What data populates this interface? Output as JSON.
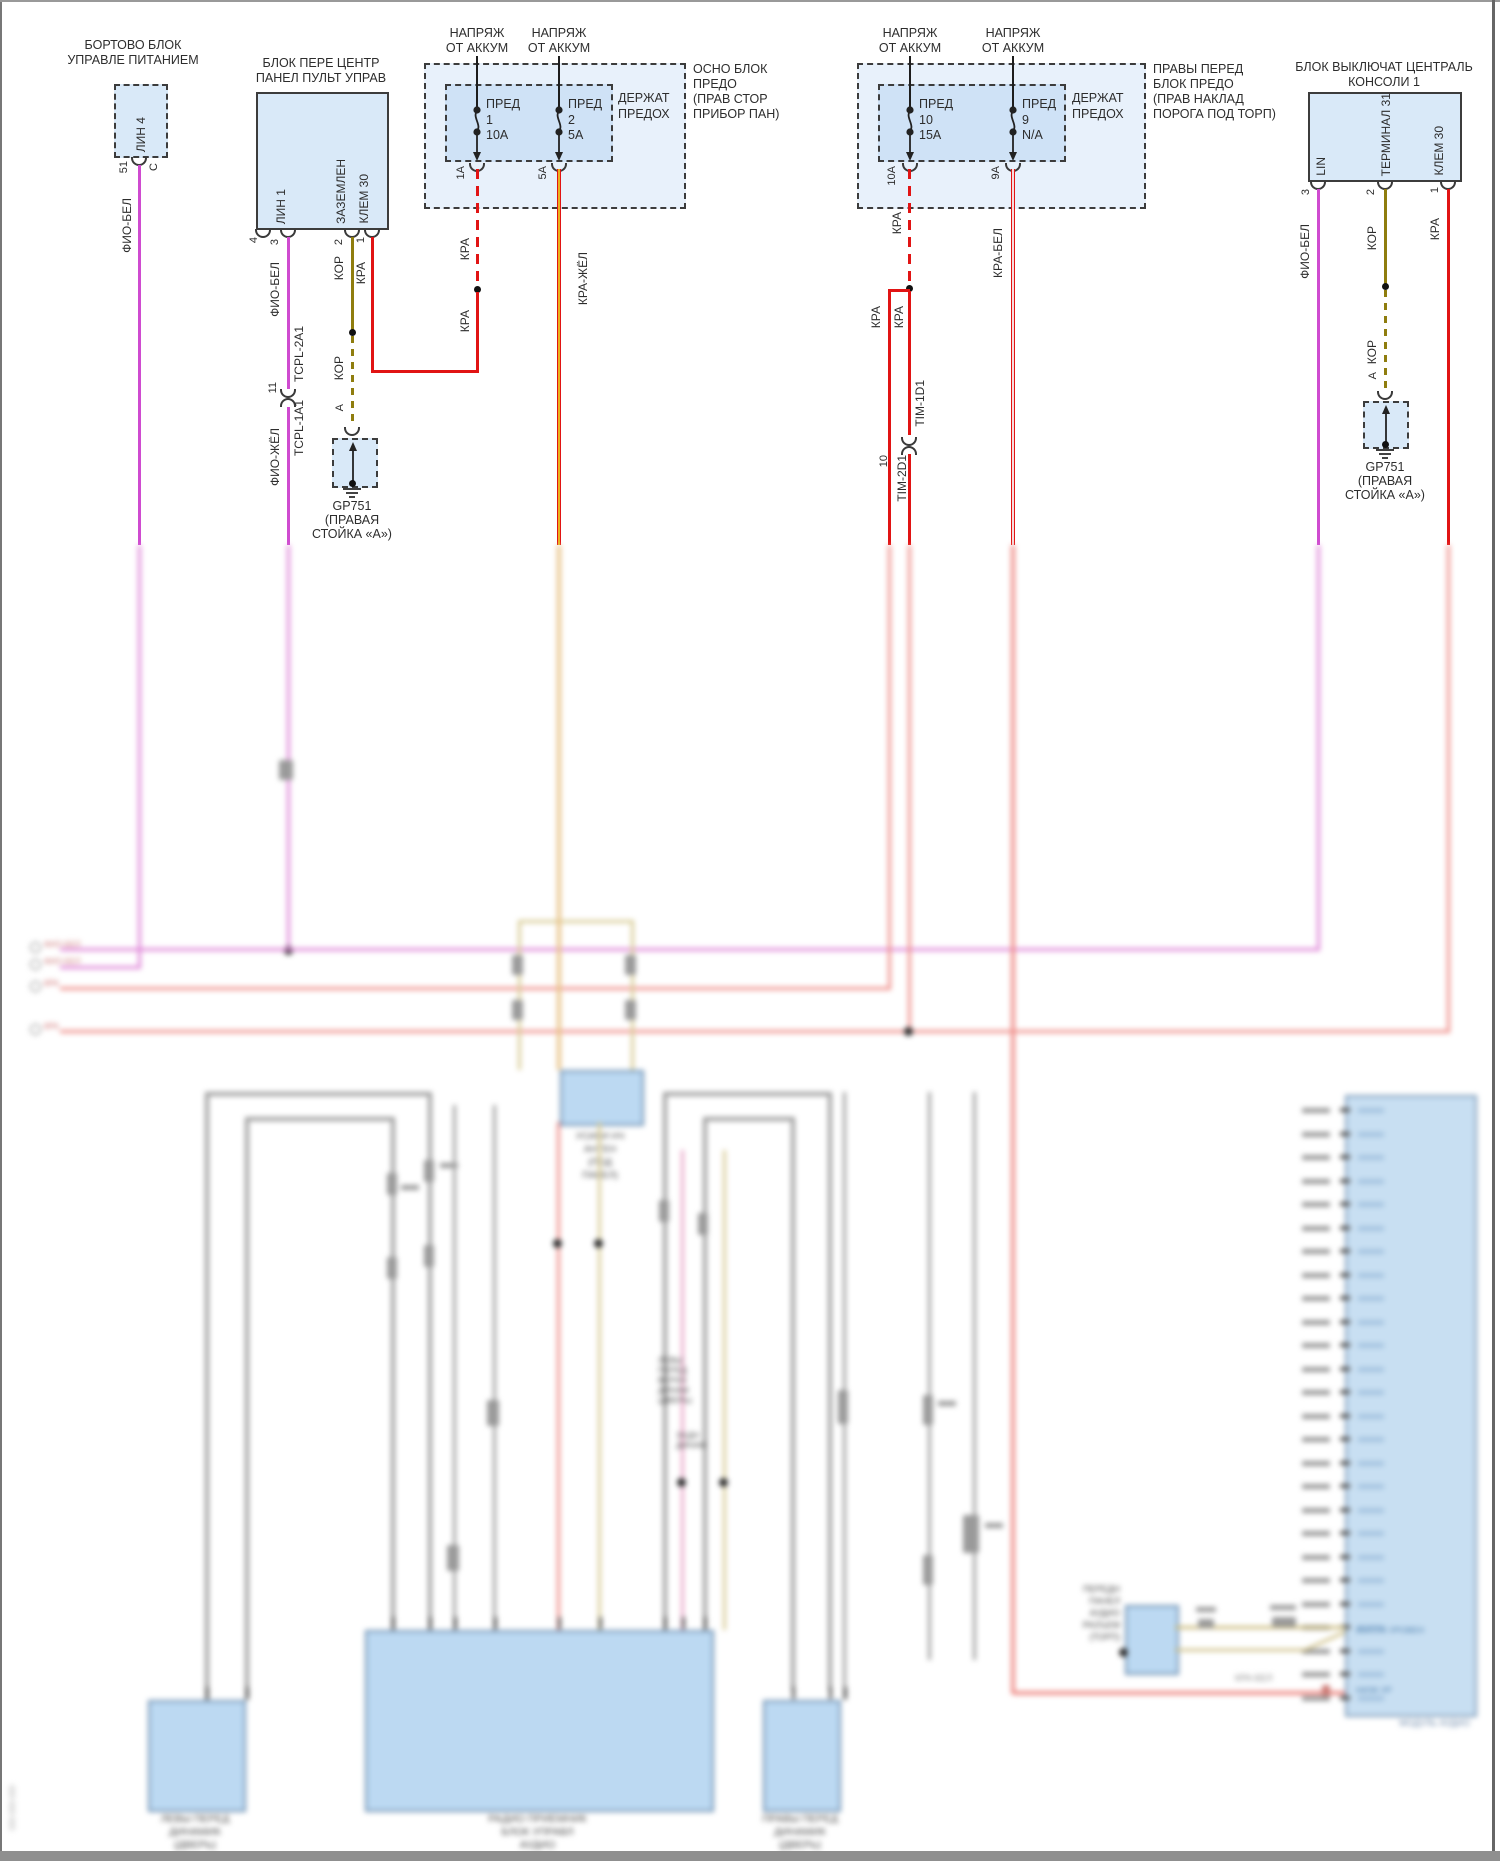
{
  "colors": {
    "wire_magenta": "#cf4bd0",
    "wire_olive": "#8f7d0e",
    "wire_red": "#e11414",
    "wire_red_yellow_stripe": "#e9b21c",
    "block_fill": "#d9e9f8"
  },
  "b1": {
    "title1": "БОРТОВО БЛОК",
    "title2": "УПРАВЛЕ ПИТАНИЕМ",
    "pin": "ЛИН 4",
    "num": "51",
    "conn_letter": "C",
    "wire": "ФИО-БЕЛ"
  },
  "b2": {
    "title1": "БЛОК ПЕРЕ ЦЕНТР",
    "title2": "ПАНЕЛ ПУЛЬТ УПРАВ",
    "pin_lin": "ЛИН 1",
    "pin_gnd": "ЗАЗЕМЛЕН",
    "pin_klem": "КЛЕМ 30",
    "n4": "4",
    "n3": "3",
    "n2": "2",
    "n1": "1",
    "w_fio_bel": "ФИО-БЕЛ",
    "n11": "11",
    "tcpl_top": "TCPL-2A1",
    "tcpl_bot": "TCPL-1A1",
    "w_fio_zhel": "ФИО-ЖЁЛ",
    "kor": "КОР",
    "kor2": "КОР",
    "kra": "КРА",
    "a": "А",
    "gp": "GP751",
    "gp2": "(ПРАВАЯ",
    "gp3": "СТОЙКА «А»)"
  },
  "fb1": {
    "feed1": [
      "НАПРЯЖ",
      "ОТ АККУМ"
    ],
    "feed2": [
      "НАПРЯЖ",
      "ОТ АККУМ"
    ],
    "holder": [
      "ДЕРЖАТ",
      "ПРЕДОХ"
    ],
    "f1": {
      "t": "ПРЕД",
      "n": "1",
      "a": "10A",
      "out": "1A"
    },
    "f2": {
      "t": "ПРЕД",
      "n": "2",
      "a": "5A",
      "out": "5A"
    },
    "side": [
      "ОСНО БЛОК",
      "ПРЕДО",
      "(ПРАВ СТОР",
      "ПРИБОР ПАН)"
    ],
    "kra_dash": "КРА",
    "kra_solid": "КРА",
    "kra_v1": "КРА",
    "w_kra_zhel": "КРА-ЖЁЛ"
  },
  "fb2": {
    "feed1": [
      "НАПРЯЖ",
      "ОТ АККУМ"
    ],
    "feed2": [
      "НАПРЯЖ",
      "ОТ АККУМ"
    ],
    "holder": [
      "ДЕРЖАТ",
      "ПРЕДОХ"
    ],
    "f1": {
      "t": "ПРЕД",
      "n": "10",
      "a": "15A",
      "out": "10A"
    },
    "f2": {
      "t": "ПРЕД",
      "n": "9",
      "a": "N/A",
      "out": "9A"
    },
    "side": [
      "ПРАВЫ ПЕРЕД",
      "БЛОК ПРЕДО",
      "(ПРАВ НАКЛАД",
      "ПОРОГА ПОД ТОРП)"
    ],
    "kra_l": "КРА",
    "kra_r": "КРА",
    "n10": "10",
    "tim_top": "TIM-1D1",
    "tim_bot": "TIM-2D1",
    "w_kra_bel": "КРА-БЕЛ"
  },
  "b3": {
    "title1": "БЛОК ВЫКЛЮЧАТ ЦЕНТРАЛЬ",
    "title2": "КОНСОЛИ 1",
    "pin_lin": "LIN",
    "pin_term": "ТЕРМИНАЛ 31",
    "pin_klem": "КЛЕМ 30",
    "n3": "3",
    "n2": "2",
    "n1": "1",
    "w_fio_bel": "ФИО-БЕЛ",
    "kor": "КОР",
    "kor2": "КОР",
    "kra": "КРА",
    "a": "А",
    "gp": "GP751",
    "gp2": "(ПРАВАЯ",
    "gp3": "СТОЙКА «А»)"
  },
  "blur": {
    "note": "lower part of source screenshot is out of focus / illegible",
    "stubs": [
      "ФИО-БЕЛ",
      "ФИО-БЕЛ",
      "КРА",
      "КРА"
    ],
    "amp": [
      "УСИЛИ НЧ",
      "АНТЕН",
      "(ПОД",
      "ПАНЕЛ)"
    ],
    "spk": [
      "ЛЕВЫ",
      "ПЕРЕД",
      "ВЕРХН",
      "ДИНАМ",
      "(ДВЕРЬ)"
    ],
    "spk2": [
      "ЗАДН",
      "ДИНАМ"
    ],
    "conn": [
      "ПЕРЕДН",
      "ПАНЕЛ",
      "АУДИО",
      "РАЗЪЕМ",
      "(ТОРП)"
    ],
    "kra_bel": "КРА-БЕЛ",
    "box_l": [
      "ЛЕВЫ ПЕРЕД",
      "ДИНАМИК",
      "(ДВЕРЬ)"
    ],
    "box_c": [
      "РАДИО ПРИЕМНИК",
      "БЛОК УПРАВЛ",
      "АУДИО"
    ],
    "box_r": [
      "ПРАВЫ ПЕРЕД",
      "ДИНАМИК",
      "(ДВЕРЬ)"
    ],
    "tall_in1": "ВЫСОК УРОВЕН",
    "tall_in2": "НИЗК УР",
    "tall_bottom": "МОДУЛЬ АУДИО",
    "doc": "000-000-000",
    "tick_count": 26
  }
}
